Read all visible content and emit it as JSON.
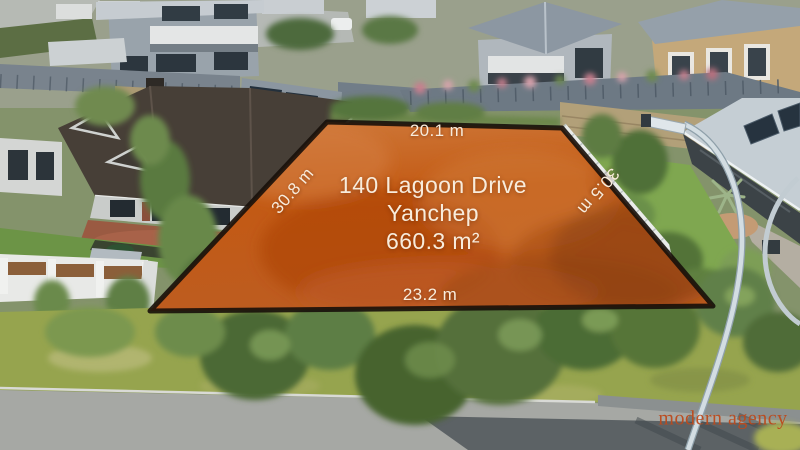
{
  "lot": {
    "address_line1": "140 Lagoon Drive",
    "address_line2": "Yanchep",
    "area": "660.3 m²",
    "dim_top": "20.1 m",
    "dim_left": "30.8 m",
    "dim_right": "30.5 m",
    "dim_bottom": "23.2 m",
    "highlight_color": "#c6601c",
    "border_color": "#17100a",
    "label_color": "#f8ecdc"
  },
  "watermark": {
    "text": "modern agency",
    "color": "#bc4a1d"
  }
}
